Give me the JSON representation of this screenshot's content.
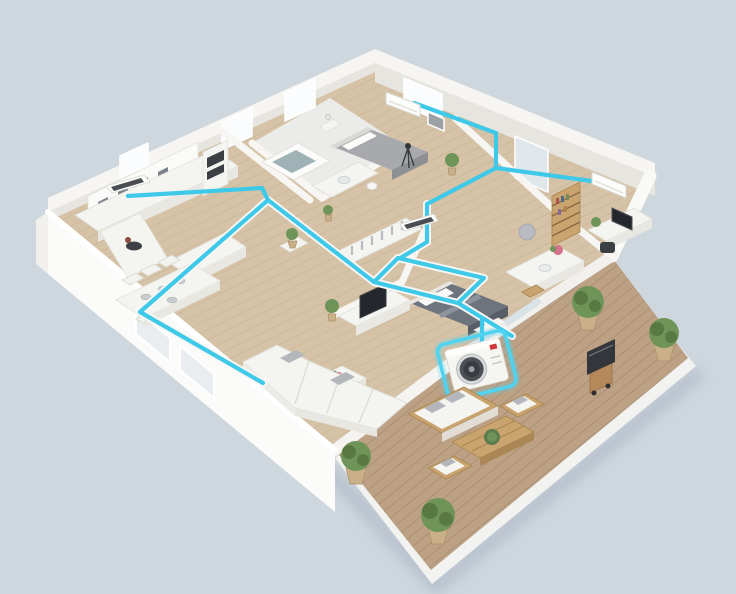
{
  "scene": {
    "type": "3d-isometric-cutaway-floor-plan",
    "description": "3D rendered cutaway floor plan of a single-storey home with a multi-split air-conditioning system: bright cyan refrigerant ducts run along the wall tops connecting a highlighted outdoor unit to indoor wall-mounted units and concealed vents in each room; a large wooden terrace with outdoor lounge furniture, barbecue grill and potted plants occupies the lower right.",
    "rooms": [
      "kitchen",
      "dining-area",
      "bathroom",
      "bedroom-1",
      "hallway",
      "walk-in-closet",
      "wc",
      "bedroom-2",
      "home-office",
      "vanity-room",
      "living-room",
      "terrace"
    ],
    "hvac": {
      "outdoor_unit": {
        "label": "outdoor-unit",
        "highlighted": true,
        "fan": "round-fan-grille",
        "logo_color": "#cf3a38"
      },
      "indoor_wall_units": 2,
      "concealed_duct_vents": 2,
      "duct_runs": 8
    },
    "furniture": [
      "kitchen-counter",
      "upper-cabinets",
      "oven-tower",
      "kitchen-island",
      "dining-table",
      "dining-chairs",
      "bathtub",
      "bathroom-vanity",
      "bed-1",
      "nightstand",
      "telescope",
      "bookshelf",
      "office-desk",
      "office-chair",
      "pouf",
      "wardrobe-closet",
      "bed-2",
      "vanity-counter",
      "tv",
      "tv-console",
      "l-shaped-sofa",
      "coffee-table",
      "outdoor-sofa",
      "outdoor-armchair-1",
      "outdoor-armchair-2",
      "outdoor-coffee-table",
      "barbecue-grill"
    ],
    "plants_count": 9
  },
  "colors": {
    "background": "#cfd7de",
    "ground_shadow": "#a4aebd",
    "deck_wood": "#bda185",
    "interior_wood": "#d6c3a7",
    "wall": "#f7f6f3",
    "wall_bright": "#fbfbf9",
    "duct": "#3fc9e9",
    "highlight": "#4ed4f0",
    "bath_tile": "#ecedec",
    "bed_gray": "#a7a9ac",
    "bed_dark": "#6e747e",
    "screen_dark": "#24282c",
    "fan_dark": "#383c40",
    "logo_red": "#cf3a38",
    "flower_pink": "#d4728a",
    "plant_green": "#6f9457",
    "outdoor_wood": "#c9a46f"
  }
}
